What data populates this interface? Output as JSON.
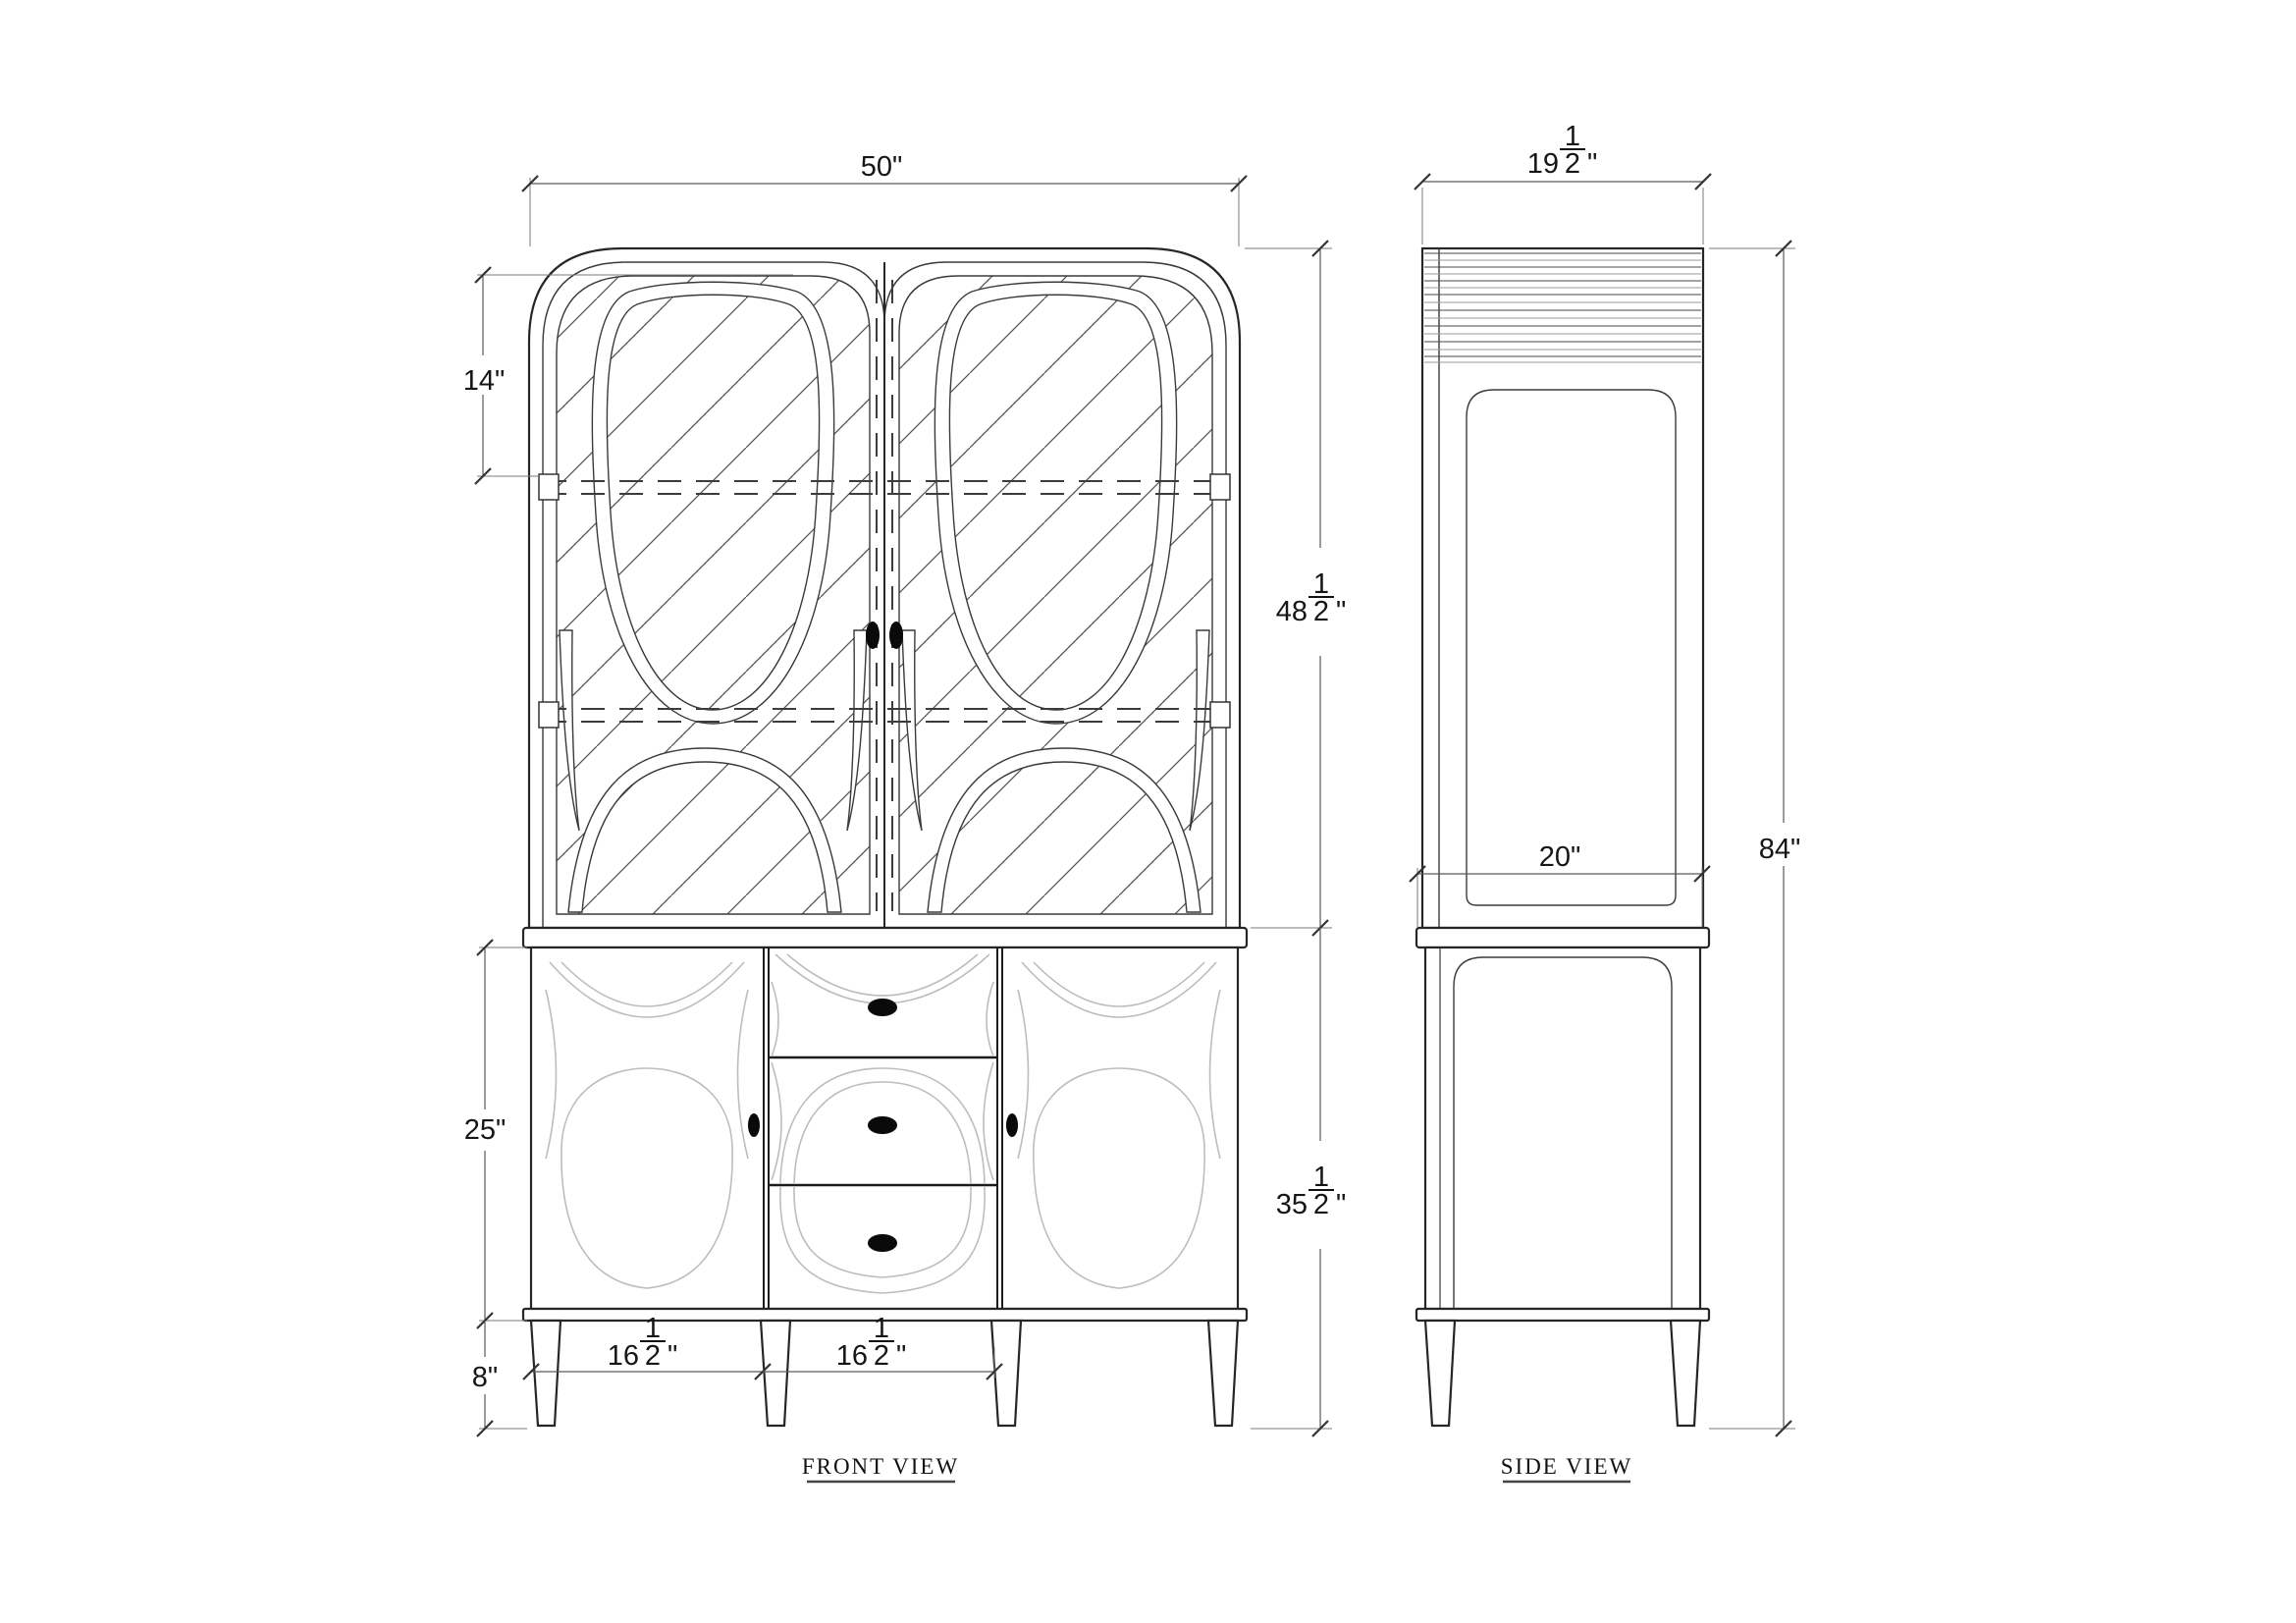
{
  "drawing": {
    "front_label": "FRONT VIEW",
    "side_label": "SIDE VIEW"
  },
  "dims": {
    "overall_width": {
      "text": "50\""
    },
    "shelf_height": {
      "text": "14\""
    },
    "hutch_height": {
      "whole": "48",
      "num": "1",
      "den": "2",
      "unit": "\""
    },
    "base_height": {
      "whole": "35",
      "num": "1",
      "den": "2",
      "unit": "\""
    },
    "total_height": {
      "text": "84\""
    },
    "top_depth": {
      "whole": "19",
      "num": "1",
      "den": "2",
      "unit": "\""
    },
    "base_depth": {
      "text": "20\""
    },
    "door_height": {
      "text": "25\""
    },
    "leg_height": {
      "text": "8\""
    },
    "left_bay_width": {
      "whole": "16",
      "num": "1",
      "den": "2",
      "unit": "\""
    },
    "center_bay_width": {
      "whole": "16",
      "num": "1",
      "den": "2",
      "unit": "\""
    }
  }
}
